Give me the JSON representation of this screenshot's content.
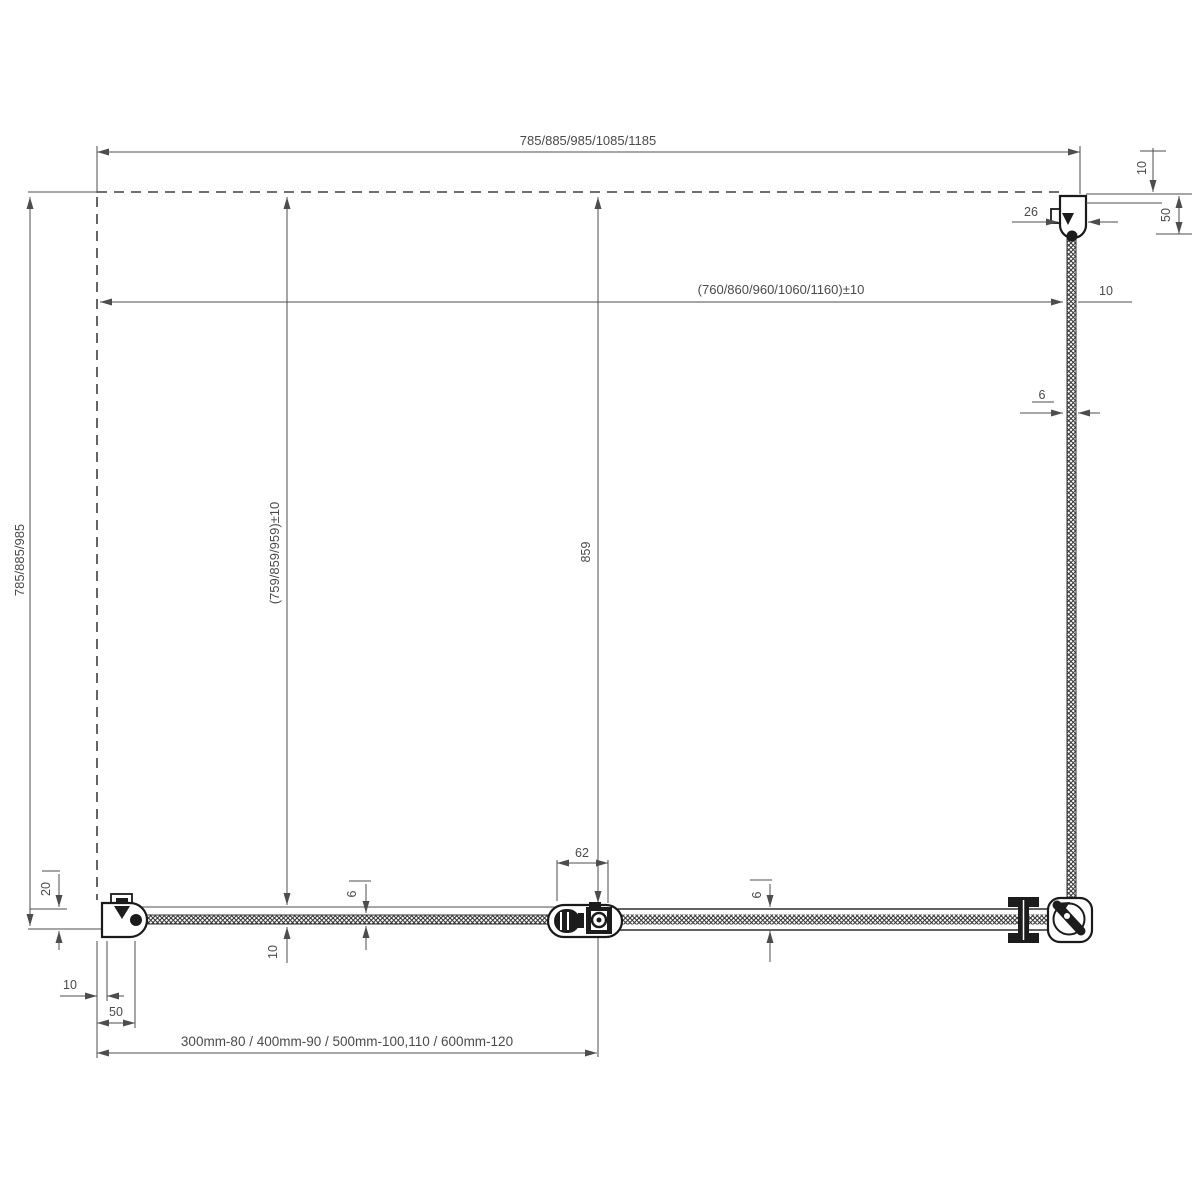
{
  "diagram": {
    "title": "shower-enclosure-installation-drawing",
    "colors": {
      "background": "#ffffff",
      "dimension_line": "#4d4d4d",
      "profile_line": "#1a1a1a",
      "text": "#4a4a4a"
    },
    "labels": {
      "total_width": "785/885/985/1085/1185",
      "glass_width": "(760/860/960/1060/1160)±10",
      "side_gap_right": "10",
      "profile_offset_top": "10",
      "profile_width_26": "26",
      "profile_height_50": "50",
      "glass_thickness_side": "6",
      "total_depth": "785/885/985",
      "door_width": "(759/859/959)±10",
      "fixed_panel_width": "859",
      "hinge_width": "62",
      "door_glass_thickness": "6",
      "fixed_glass_thickness": "6",
      "door_edge_gap": "10",
      "wall_gap_20": "20",
      "wall_gap_10": "10",
      "profile_width_50": "50",
      "extension_profiles": "300mm-80 / 400mm-90 / 500mm-100,110 / 600mm-120"
    }
  }
}
